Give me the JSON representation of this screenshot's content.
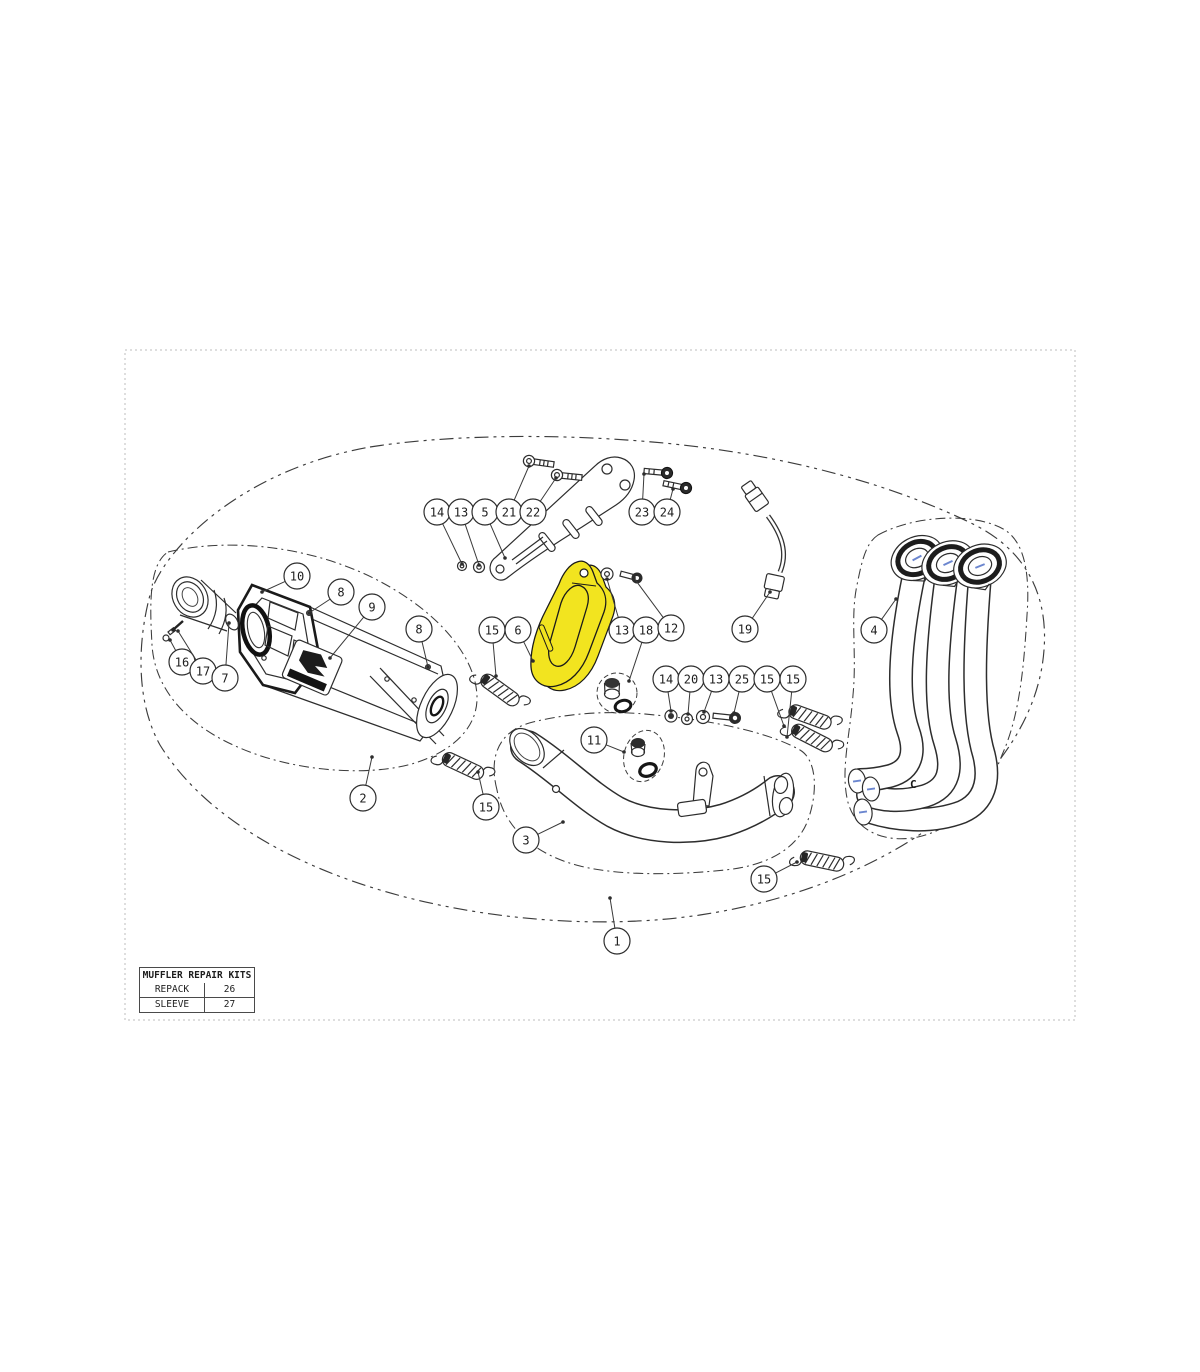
{
  "diagram": {
    "highlight_color": "#f2e41f",
    "line_color": "#2d2d2d",
    "accent_blue": "#6b86cf",
    "muffler_badge_icon": "akrapovic-logo",
    "collector_mark": "C",
    "callouts": [
      {
        "n": "14",
        "x": 437,
        "y": 512,
        "tx": 462,
        "ty": 564
      },
      {
        "n": "13",
        "x": 461,
        "y": 512,
        "tx": 479,
        "ty": 565
      },
      {
        "n": "5",
        "x": 485,
        "y": 512,
        "tx": 505,
        "ty": 558
      },
      {
        "n": "21",
        "x": 509,
        "y": 512,
        "tx": 529,
        "ty": 466
      },
      {
        "n": "22",
        "x": 533,
        "y": 512,
        "tx": 556,
        "ty": 478
      },
      {
        "n": "23",
        "x": 642,
        "y": 512,
        "tx": 644,
        "ty": 474
      },
      {
        "n": "24",
        "x": 667,
        "y": 512,
        "tx": 673,
        "ty": 489
      },
      {
        "n": "10",
        "x": 297,
        "y": 576,
        "tx": 262,
        "ty": 592
      },
      {
        "n": "8",
        "x": 341,
        "y": 592,
        "tx": 309,
        "ty": 613
      },
      {
        "n": "9",
        "x": 372,
        "y": 607,
        "tx": 330,
        "ty": 658
      },
      {
        "n": "8",
        "x": 419,
        "y": 629,
        "tx": 428,
        "ty": 667
      },
      {
        "n": "16",
        "x": 182,
        "y": 662,
        "tx": 170,
        "ty": 640
      },
      {
        "n": "17",
        "x": 203,
        "y": 671,
        "tx": 178,
        "ty": 631
      },
      {
        "n": "7",
        "x": 225,
        "y": 678,
        "tx": 229,
        "ty": 623
      },
      {
        "n": "15",
        "x": 492,
        "y": 630,
        "tx": 496,
        "ty": 676
      },
      {
        "n": "6",
        "x": 518,
        "y": 630,
        "tx": 533,
        "ty": 661
      },
      {
        "n": "13",
        "x": 622,
        "y": 630,
        "tx": 607,
        "ty": 579
      },
      {
        "n": "18",
        "x": 646,
        "y": 630,
        "tx": 629,
        "ty": 681
      },
      {
        "n": "12",
        "x": 671,
        "y": 628,
        "tx": 634,
        "ty": 578
      },
      {
        "n": "19",
        "x": 745,
        "y": 629,
        "tx": 770,
        "ty": 592
      },
      {
        "n": "4",
        "x": 874,
        "y": 630,
        "tx": 896,
        "ty": 599
      },
      {
        "n": "14",
        "x": 666,
        "y": 679,
        "tx": 671,
        "ty": 711
      },
      {
        "n": "20",
        "x": 691,
        "y": 679,
        "tx": 688,
        "ty": 714
      },
      {
        "n": "13",
        "x": 716,
        "y": 679,
        "tx": 704,
        "ty": 712
      },
      {
        "n": "25",
        "x": 742,
        "y": 679,
        "tx": 734,
        "ty": 713
      },
      {
        "n": "15",
        "x": 767,
        "y": 679,
        "tx": 784,
        "ty": 726
      },
      {
        "n": "15",
        "x": 793,
        "y": 679,
        "tx": 787,
        "ty": 737
      },
      {
        "n": "11",
        "x": 594,
        "y": 740,
        "tx": 624,
        "ty": 752
      },
      {
        "n": "2",
        "x": 363,
        "y": 798,
        "tx": 372,
        "ty": 757
      },
      {
        "n": "15",
        "x": 486,
        "y": 807,
        "tx": 478,
        "ty": 772
      },
      {
        "n": "3",
        "x": 526,
        "y": 840,
        "tx": 563,
        "ty": 822
      },
      {
        "n": "15",
        "x": 764,
        "y": 879,
        "tx": 797,
        "ty": 862
      },
      {
        "n": "1",
        "x": 617,
        "y": 941,
        "tx": 610,
        "ty": 898
      }
    ]
  },
  "table": {
    "title": "MUFFLER REPAIR KITS",
    "rows": [
      {
        "label": "REPACK",
        "value": "26"
      },
      {
        "label": "SLEEVE",
        "value": "27"
      }
    ]
  }
}
